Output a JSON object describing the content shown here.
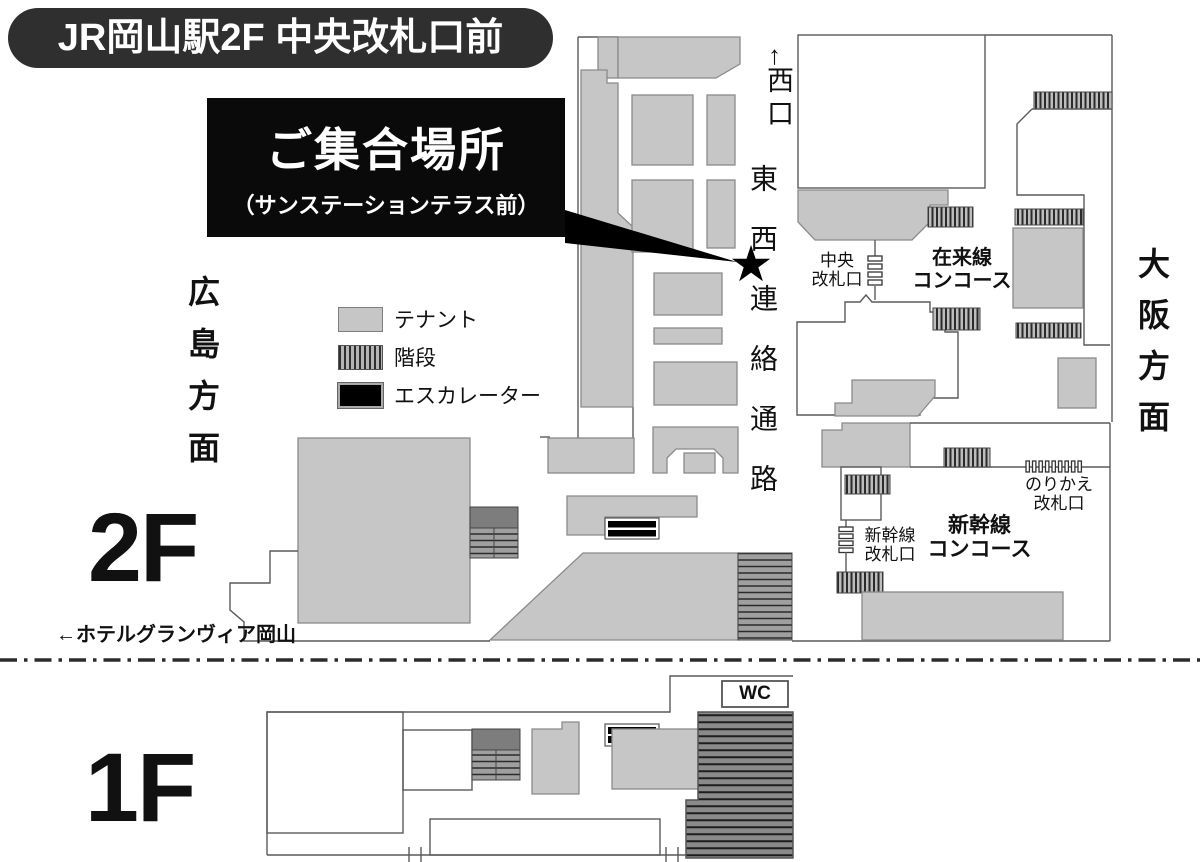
{
  "header": {
    "title": "JR岡山駅2F 中央改札口前"
  },
  "meeting": {
    "title": "ご集合場所",
    "subtitle": "（サンステーションテラス前）",
    "marker": "★"
  },
  "directions": {
    "west_exit_arrow": "↑",
    "west_exit": "西口",
    "corridor": "東西連絡通路",
    "osaka": "大阪方面",
    "hiroshima": "広島方面",
    "hotel": "←ホテルグランヴィア岡山"
  },
  "floors": {
    "second": "2F",
    "first": "1F"
  },
  "labels": {
    "central_gate": {
      "line1": "中央",
      "line2": "改札口"
    },
    "conventional_concourse": {
      "line1": "在来線",
      "line2": "コンコース"
    },
    "transfer_gate": {
      "line1": "のりかえ",
      "line2": "改札口"
    },
    "shinkansen_gate": {
      "line1": "新幹線",
      "line2": "改札口"
    },
    "shinkansen_concourse": {
      "line1": "新幹線",
      "line2": "コンコース"
    },
    "wc": "WC"
  },
  "legend": {
    "items": [
      {
        "type": "tenant",
        "label": "テナント"
      },
      {
        "type": "stairs",
        "label": "階段"
      },
      {
        "type": "escalator",
        "label": "エスカレーター"
      }
    ]
  },
  "colors": {
    "tenant_fill": "#c6c6c6",
    "stairs_dark": "#7d7d7d",
    "badge_bg": "#2f2f2f",
    "marker_black": "#000000"
  }
}
